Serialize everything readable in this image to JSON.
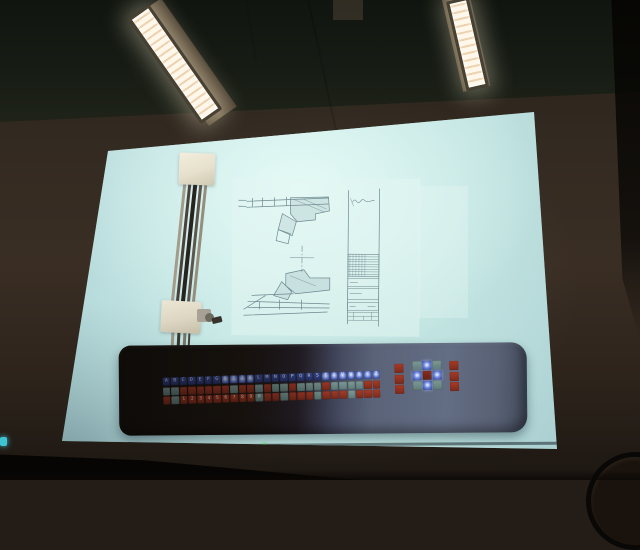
{
  "photo": {
    "room": {
      "light_fixture_count": 2,
      "colors": {
        "lamp_glow": "#fff4e0",
        "ceiling": "#141a14",
        "wall": "#342a21"
      }
    },
    "projection": {
      "colors": {
        "screen_glow": "#cdeeea",
        "screen_edge": "#8fb2ba",
        "sheet": "#e4f6f2",
        "drawing_line": "#5a7680"
      }
    },
    "keyboard_panel": {
      "colors": {
        "body_dark": "#16110d",
        "body_lit": "#5f6880",
        "key_blue": "#35488f",
        "key_blue_lit": "#7e97e8",
        "key_red": "#a03828",
        "key_gray": "#7e9a95"
      },
      "letter_keys": "ABCDEFGHIJKLMNOPQRSTUVWXYZ",
      "letter_lit_indexes": [
        7,
        8,
        9,
        10,
        19,
        20,
        21,
        22,
        23,
        24,
        25
      ],
      "symbol_row_colors": [
        "g",
        "g",
        "r",
        "r",
        "r",
        "r",
        "r",
        "r",
        "g",
        "r",
        "r",
        "g",
        "r",
        "g",
        "g",
        "r",
        "g",
        "g",
        "g",
        "r",
        "g",
        "g",
        "g",
        "g",
        "r",
        "r"
      ],
      "digit_row_labels": [
        "",
        "",
        "1",
        "2",
        "3",
        "4",
        "5",
        "6",
        "7",
        "8",
        "9",
        "0",
        "",
        "",
        "",
        "",
        "",
        "",
        "",
        "",
        "",
        "",
        "",
        "",
        "",
        ""
      ],
      "digit_row_colors": [
        "r",
        "g",
        "r",
        "r",
        "r",
        "r",
        "r",
        "r",
        "r",
        "r",
        "r",
        "g",
        "r",
        "r",
        "g",
        "r",
        "r",
        "r",
        "g",
        "r",
        "r",
        "r",
        "g",
        "r",
        "r",
        "r"
      ],
      "left_button_column": [
        "r",
        "r",
        "r"
      ],
      "center_button_grid": [
        "g",
        "L",
        "g",
        "L",
        "R",
        "L",
        "g",
        "L",
        "g"
      ],
      "right_button_column": [
        "r",
        "r",
        "r"
      ]
    }
  }
}
